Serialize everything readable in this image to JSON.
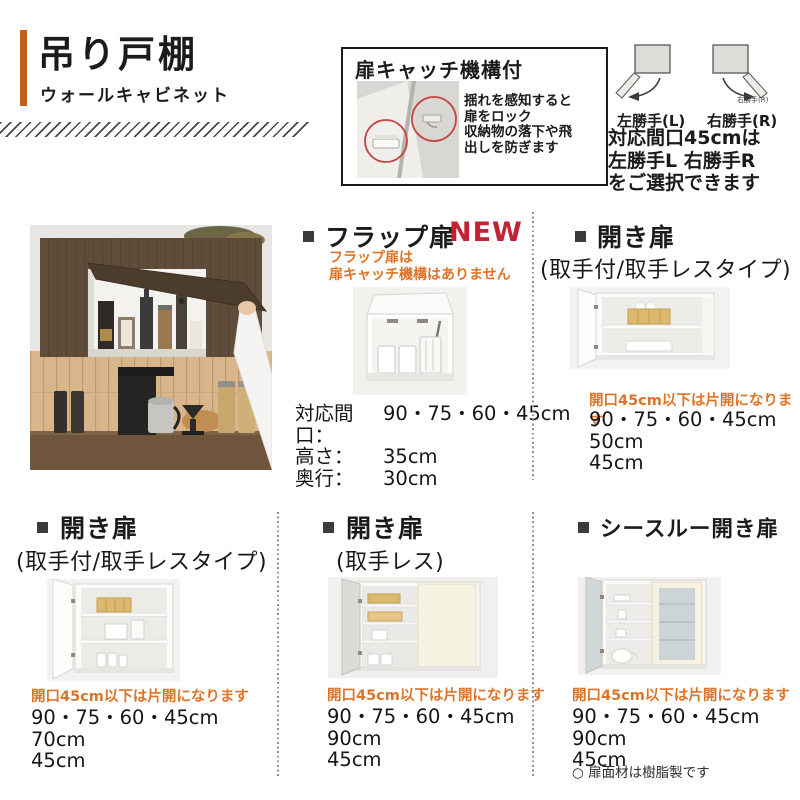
{
  "colors": {
    "accent_orange": "#C2611F",
    "note_orange": "#DD7428",
    "new_red": "#C32134",
    "text_black": "#1B1B1B"
  },
  "header": {
    "title": "吊り戸棚",
    "subtitle": "ウォールキャビネット"
  },
  "catch_box": {
    "title": "扉キャッチ機構付",
    "desc1": "揺れを感知すると",
    "desc2": "扉をロック",
    "desc3": "収納物の落下や飛",
    "desc4": "出しを防ぎます"
  },
  "handing": {
    "left_label": "左勝手(L)",
    "right_label": "右勝手(R)",
    "right_small_label": "右勝手(R)",
    "note1": "対応間口45cmは",
    "note2": "左勝手L 右勝手R",
    "note3": "をご選択できます"
  },
  "flap": {
    "title": "フラップ扉",
    "badge": "NEW",
    "warn1": "フラップ扉は",
    "warn2": "扉キャッチ機構はありません",
    "spec1_label": "対応間口：",
    "spec1_value": "90・75・60・45cm",
    "spec2_label": "高さ：",
    "spec2_value": "35cm",
    "spec3_label": "奥行：",
    "spec3_value": "30cm"
  },
  "hinged_top": {
    "title": "開き扉",
    "subtitle": "(取手付/取手レスタイプ)",
    "note": "開口45cm以下は片開になります",
    "spec1": "90・75・60・45cm",
    "spec2": "50cm",
    "spec3": "45cm"
  },
  "hinged_left": {
    "title": "開き扉",
    "subtitle": "(取手付/取手レスタイプ)",
    "note": "開口45cm以下は片開になります",
    "spec1": "90・75・60・45cm",
    "spec2": "70cm",
    "spec3": "45cm"
  },
  "hinged_mid": {
    "title": "開き扉",
    "subtitle": "(取手レス)",
    "note": "開口45cm以下は片開になります",
    "spec1": "90・75・60・45cm",
    "spec2": "90cm",
    "spec3": "45cm"
  },
  "see_through": {
    "title": "シースルー開き扉",
    "note": "開口45cm以下は片開になります",
    "spec1": "90・75・60・45cm",
    "spec2": "90cm",
    "spec3": "45cm",
    "footnote": "○ 扉面材は樹脂製です"
  }
}
